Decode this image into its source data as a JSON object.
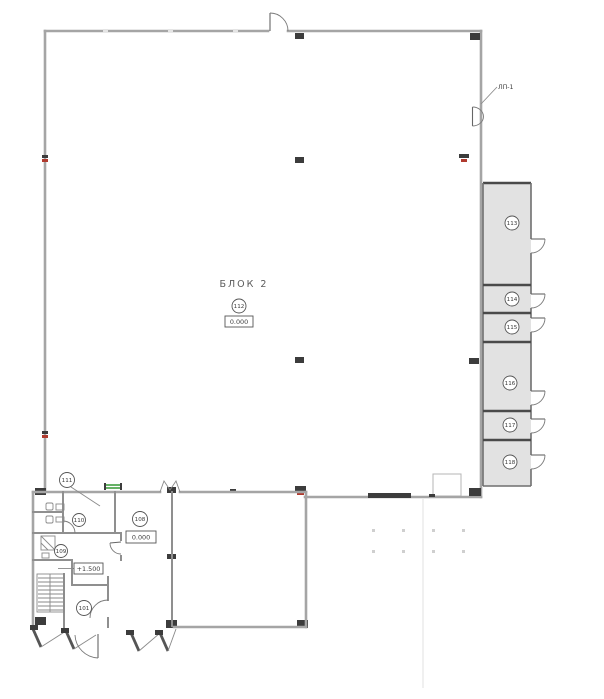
{
  "drawing": {
    "block_title": "БЛОК 2",
    "main_room": {
      "number": "112",
      "elevation": "0.000"
    },
    "ladder_label": "ЛП-1",
    "right_rooms": [
      "113",
      "114",
      "115",
      "116",
      "117",
      "118"
    ],
    "annex": {
      "room_111": "111",
      "room_110": "110",
      "room_109": "109",
      "room_108": "108",
      "room_101": "101",
      "elevation_main": "0.000",
      "elevation_entry": "+1.500"
    },
    "colors": {
      "background": "#ffffff",
      "wall": "#a5a5a5",
      "wall_dark": "#4a4a4a",
      "room_fill": "#e2e2e2",
      "column": "#3c3c3c",
      "accent_red": "#b03a2e",
      "accent_green": "#3f9e3f",
      "text": "#3a3a3a"
    }
  }
}
